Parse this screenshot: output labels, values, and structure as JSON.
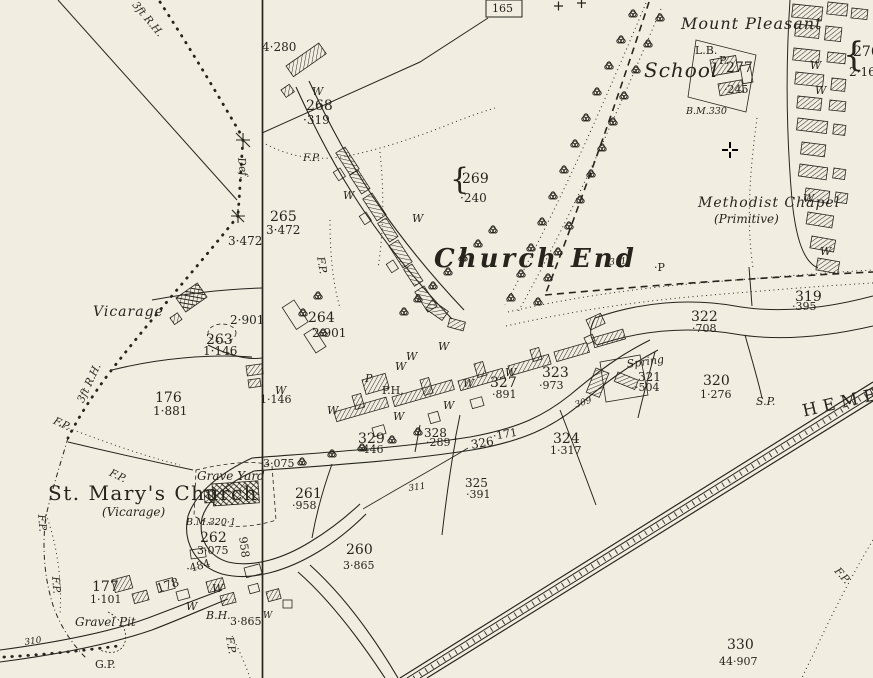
{
  "colors": {
    "paper": "#f1eee1",
    "ink": "#26241d"
  },
  "map": {
    "region_title": "Church End",
    "cursor": {
      "x": 730,
      "y": 150
    },
    "labels": [
      {
        "t": "Mount Pleasant",
        "x": 681,
        "y": 16,
        "c": "pl-lg-italic"
      },
      {
        "t": "School",
        "x": 644,
        "y": 60,
        "c": "pl-xl-italic"
      },
      {
        "t": "Methodist Chapel",
        "x": 698,
        "y": 196,
        "c": "pl-md-italic"
      },
      {
        "t": "(Primitive)",
        "x": 714,
        "y": 213,
        "c": "pl-sm-italic"
      },
      {
        "t": "Church End",
        "x": 434,
        "y": 246,
        "c": "pl-title"
      },
      {
        "t": "St. Mary's Church",
        "x": 48,
        "y": 483,
        "c": "pl-church"
      },
      {
        "t": "(Vicarage)",
        "x": 102,
        "y": 506,
        "c": "pl-sm-italic"
      },
      {
        "t": "Vicarage",
        "x": 93,
        "y": 305,
        "c": "pl-md-italic"
      },
      {
        "t": "Grave Yard",
        "x": 197,
        "y": 470,
        "c": "pl-sm-italic"
      },
      {
        "t": "Gravel Pit",
        "x": 75,
        "y": 616,
        "c": "pl-sm-italic"
      },
      {
        "t": "Spring",
        "x": 626,
        "y": 359,
        "c": "pl-xs-italic",
        "r": -8
      },
      {
        "t": "HEMEL",
        "x": 801,
        "y": 404,
        "c": "road-name",
        "r": -13
      },
      {
        "t": "165",
        "x": 492,
        "y": 3,
        "c": "num-box"
      },
      {
        "t": "4·280",
        "x": 262,
        "y": 41,
        "c": "area"
      },
      {
        "t": "W",
        "x": 312,
        "y": 86,
        "c": "w"
      },
      {
        "t": "268",
        "x": 306,
        "y": 99,
        "c": "num"
      },
      {
        "t": "·319",
        "x": 303,
        "y": 114,
        "c": "area"
      },
      {
        "t": "{",
        "x": 450,
        "y": 165,
        "c": "brace"
      },
      {
        "t": "269",
        "x": 462,
        "y": 172,
        "c": "num"
      },
      {
        "t": "·240",
        "x": 460,
        "y": 192,
        "c": "area"
      },
      {
        "t": "F.P.",
        "x": 303,
        "y": 153,
        "c": "fp"
      },
      {
        "t": "F.P.",
        "x": 325,
        "y": 256,
        "c": "fp",
        "r": 80
      },
      {
        "t": "Def.",
        "x": 246,
        "y": 157,
        "c": "fp",
        "r": 83
      },
      {
        "t": "3ft R.H.",
        "x": 138,
        "y": 0,
        "c": "fp",
        "r": 50
      },
      {
        "t": "3ft R.H.",
        "x": 76,
        "y": 400,
        "c": "fp",
        "r": -65
      },
      {
        "t": "265",
        "x": 270,
        "y": 210,
        "c": "num"
      },
      {
        "t": "3·472",
        "x": 266,
        "y": 224,
        "c": "area"
      },
      {
        "t": "3·472",
        "x": 228,
        "y": 235,
        "c": "area"
      },
      {
        "t": "2·901",
        "x": 230,
        "y": 314,
        "c": "area"
      },
      {
        "t": "264",
        "x": 308,
        "y": 311,
        "c": "num"
      },
      {
        "t": "2·901",
        "x": 312,
        "y": 327,
        "c": "area"
      },
      {
        "t": "263",
        "x": 206,
        "y": 333,
        "c": "num"
      },
      {
        "t": "1·146",
        "x": 203,
        "y": 345,
        "c": "area"
      },
      {
        "t": "176",
        "x": 155,
        "y": 391,
        "c": "num"
      },
      {
        "t": "1·881",
        "x": 153,
        "y": 405,
        "c": "area"
      },
      {
        "t": "W",
        "x": 275,
        "y": 385,
        "c": "w"
      },
      {
        "t": "1·146",
        "x": 260,
        "y": 394,
        "c": "area-sm"
      },
      {
        "t": "L.B.",
        "x": 695,
        "y": 45,
        "c": "small"
      },
      {
        "t": "P.",
        "x": 719,
        "y": 55,
        "c": "small"
      },
      {
        "t": "277",
        "x": 726,
        "y": 61,
        "c": "num"
      },
      {
        "t": "·245",
        "x": 724,
        "y": 84,
        "c": "area-sm"
      },
      {
        "t": "B.M.330",
        "x": 686,
        "y": 107,
        "c": "bm"
      },
      {
        "t": "{",
        "x": 843,
        "y": 38,
        "c": "brace2"
      },
      {
        "t": "276",
        "x": 853,
        "y": 45,
        "c": "num"
      },
      {
        "t": "2·16",
        "x": 849,
        "y": 66,
        "c": "area"
      },
      {
        "t": "311",
        "x": 609,
        "y": 259,
        "c": "tiny-italic",
        "r": -5
      },
      {
        "t": "·P",
        "x": 654,
        "y": 262,
        "c": "small"
      },
      {
        "t": "319",
        "x": 795,
        "y": 290,
        "c": "num"
      },
      {
        "t": "·395",
        "x": 792,
        "y": 301,
        "c": "area-sm"
      },
      {
        "t": "322",
        "x": 691,
        "y": 310,
        "c": "num"
      },
      {
        "t": "·708",
        "x": 692,
        "y": 323,
        "c": "area-sm"
      },
      {
        "t": "323",
        "x": 542,
        "y": 366,
        "c": "num"
      },
      {
        "t": "·973",
        "x": 539,
        "y": 380,
        "c": "area-sm"
      },
      {
        "t": "327",
        "x": 490,
        "y": 376,
        "c": "num"
      },
      {
        "t": "·891",
        "x": 492,
        "y": 389,
        "c": "area-sm"
      },
      {
        "t": "W",
        "x": 505,
        "y": 367,
        "c": "w"
      },
      {
        "t": "321",
        "x": 638,
        "y": 371,
        "c": "num-sm"
      },
      {
        "t": "·504",
        "x": 635,
        "y": 382,
        "c": "area-sm"
      },
      {
        "t": "320",
        "x": 703,
        "y": 374,
        "c": "num"
      },
      {
        "t": "1·276",
        "x": 700,
        "y": 389,
        "c": "area-sm"
      },
      {
        "t": "S.P.",
        "x": 756,
        "y": 396,
        "c": "small-italic"
      },
      {
        "t": "309",
        "x": 574,
        "y": 402,
        "c": "tiny-italic",
        "r": -18
      },
      {
        "t": "328",
        "x": 424,
        "y": 427,
        "c": "num-sm"
      },
      {
        "t": "·289",
        "x": 426,
        "y": 437,
        "c": "area-sm"
      },
      {
        "t": "329",
        "x": 358,
        "y": 432,
        "c": "num"
      },
      {
        "t": "·446",
        "x": 359,
        "y": 444,
        "c": "area-sm"
      },
      {
        "t": "326",
        "x": 470,
        "y": 439,
        "c": "num-sm",
        "r": -10
      },
      {
        "t": "·171",
        "x": 492,
        "y": 431,
        "c": "area-sm",
        "r": -10
      },
      {
        "t": "324",
        "x": 553,
        "y": 432,
        "c": "num"
      },
      {
        "t": "1·317",
        "x": 550,
        "y": 445,
        "c": "area-sm"
      },
      {
        "t": "325",
        "x": 465,
        "y": 477,
        "c": "num-sm"
      },
      {
        "t": "·391",
        "x": 466,
        "y": 489,
        "c": "area-sm"
      },
      {
        "t": "311",
        "x": 408,
        "y": 485,
        "c": "tiny-italic",
        "r": -8
      },
      {
        "t": "261",
        "x": 295,
        "y": 487,
        "c": "num"
      },
      {
        "t": "·958",
        "x": 292,
        "y": 500,
        "c": "area-sm"
      },
      {
        "t": "3·075",
        "x": 263,
        "y": 458,
        "c": "area-sm"
      },
      {
        "t": "260",
        "x": 346,
        "y": 543,
        "c": "num"
      },
      {
        "t": "3·865",
        "x": 343,
        "y": 560,
        "c": "area-sm"
      },
      {
        "t": "B.M.320·1",
        "x": 186,
        "y": 518,
        "c": "bm"
      },
      {
        "t": "262",
        "x": 200,
        "y": 531,
        "c": "num"
      },
      {
        "t": "3·075",
        "x": 197,
        "y": 545,
        "c": "area-sm"
      },
      {
        "t": "·484",
        "x": 185,
        "y": 564,
        "c": "area-sm",
        "r": -15
      },
      {
        "t": "958",
        "x": 248,
        "y": 536,
        "c": "area-sm",
        "r": 82
      },
      {
        "t": "177",
        "x": 92,
        "y": 580,
        "c": "num"
      },
      {
        "t": "1·101",
        "x": 90,
        "y": 594,
        "c": "area-sm"
      },
      {
        "t": "178",
        "x": 155,
        "y": 583,
        "c": "num-sm",
        "r": -18
      },
      {
        "t": "W",
        "x": 212,
        "y": 583,
        "c": "w"
      },
      {
        "t": "W",
        "x": 186,
        "y": 601,
        "c": "w"
      },
      {
        "t": "B.H.",
        "x": 206,
        "y": 610,
        "c": "small-italic"
      },
      {
        "t": "3·865",
        "x": 230,
        "y": 616,
        "c": "area-sm"
      },
      {
        "t": "W",
        "x": 263,
        "y": 612,
        "c": "w-sm"
      },
      {
        "t": "330",
        "x": 727,
        "y": 638,
        "c": "num"
      },
      {
        "t": "44·907",
        "x": 719,
        "y": 656,
        "c": "area-sm"
      },
      {
        "t": "310",
        "x": 24,
        "y": 639,
        "c": "tiny-italic",
        "r": -8
      },
      {
        "t": "G.P.",
        "x": 95,
        "y": 659,
        "c": "small"
      },
      {
        "t": "F.P.",
        "x": 56,
        "y": 416,
        "c": "fp",
        "r": 25
      },
      {
        "t": "F.P.",
        "x": 112,
        "y": 468,
        "c": "fp",
        "r": 25
      },
      {
        "t": "F.P.",
        "x": 46,
        "y": 514,
        "c": "fp",
        "r": 85
      },
      {
        "t": "F.P.",
        "x": 60,
        "y": 576,
        "c": "fp",
        "r": 85
      },
      {
        "t": "F.P.",
        "x": 234,
        "y": 636,
        "c": "fp",
        "r": 80
      },
      {
        "t": "F.P.",
        "x": 840,
        "y": 566,
        "c": "fp",
        "r": 48
      },
      {
        "t": "P",
        "x": 365,
        "y": 373,
        "c": "small-italic"
      },
      {
        "t": "P.H.",
        "x": 382,
        "y": 385,
        "c": "small"
      },
      {
        "t": "W",
        "x": 438,
        "y": 341,
        "c": "w"
      },
      {
        "t": "W",
        "x": 406,
        "y": 351,
        "c": "w"
      },
      {
        "t": "W",
        "x": 395,
        "y": 361,
        "c": "w"
      },
      {
        "t": "W",
        "x": 327,
        "y": 405,
        "c": "w"
      },
      {
        "t": "W",
        "x": 463,
        "y": 378,
        "c": "w"
      },
      {
        "t": "W",
        "x": 443,
        "y": 400,
        "c": "w"
      },
      {
        "t": "W",
        "x": 393,
        "y": 411,
        "c": "w"
      },
      {
        "t": "W",
        "x": 412,
        "y": 213,
        "c": "w"
      },
      {
        "t": "W",
        "x": 343,
        "y": 190,
        "c": "w"
      },
      {
        "t": "W",
        "x": 810,
        "y": 60,
        "c": "w"
      },
      {
        "t": "W",
        "x": 815,
        "y": 85,
        "c": "w"
      },
      {
        "t": "W",
        "x": 803,
        "y": 193,
        "c": "w"
      },
      {
        "t": "W",
        "x": 820,
        "y": 246,
        "c": "w"
      }
    ]
  }
}
